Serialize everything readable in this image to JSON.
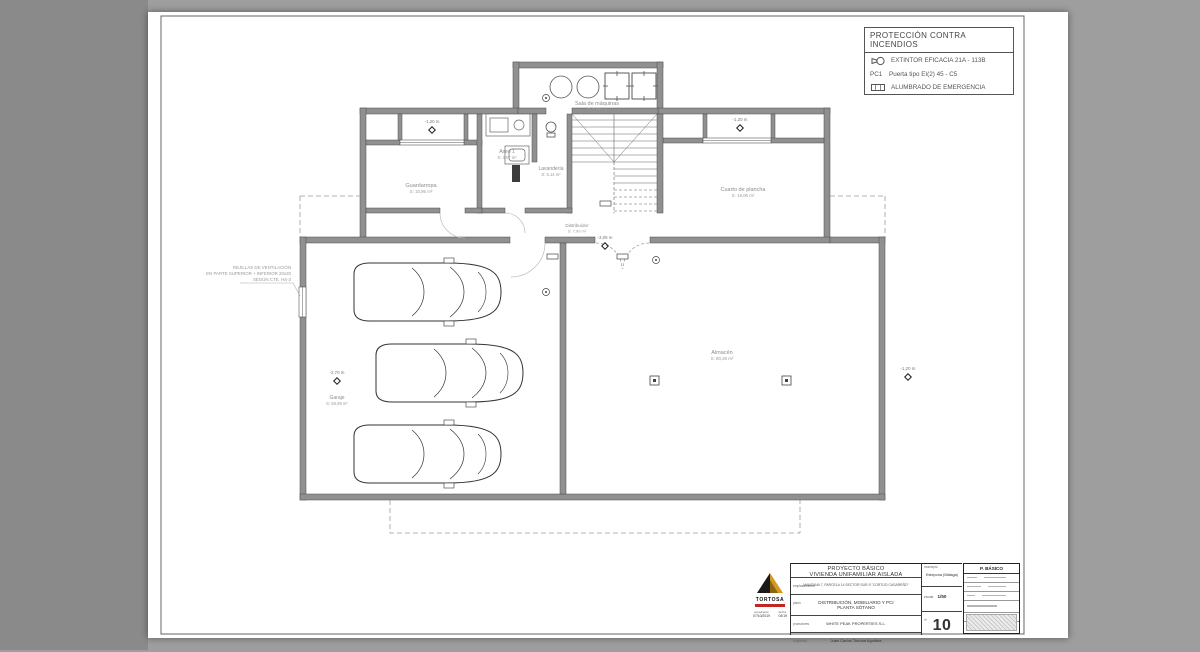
{
  "legend": {
    "title": "PROTECCIÓN CONTRA INCENDIOS",
    "row1_label": "EXTINTOR EFICACIA 21A - 113B",
    "row2_prefix": "PC1",
    "row2_label": "Puerta tipo EI(2) 45 - C5",
    "row3_label": "ALUMBRADO DE EMERGENCIA"
  },
  "plan": {
    "rooms": [
      {
        "name": "Sala de máquinas",
        "area": "S: 7,06 m²"
      },
      {
        "name": "Aseo 1",
        "area": "S: 4,07 m²"
      },
      {
        "name": "Lavandería",
        "area": "S: 5,14 m²"
      },
      {
        "name": "Guardarropa",
        "area": "S: 10,95 m²"
      },
      {
        "name": "Cuarto de plancha",
        "area": "S: 19,06 m²"
      },
      {
        "name": "Distribuidor",
        "area": "S: 7,90 m²"
      },
      {
        "name": "Garaje",
        "area": "S: 66,99 m²"
      },
      {
        "name": "Almacén",
        "area": "S: 80,28 m²"
      }
    ],
    "levels": [
      "-1,20 m",
      "-1,20 m",
      "-3,05 m",
      "-2,70 m",
      "-1,20 m"
    ],
    "note_line1": "REJILLAS DE VENTILACIÓN",
    "note_line2": "EN PARTE SUPERIOR + INFERIOR 20x20",
    "note_line3": "SEGÚN CTE. HS-3"
  },
  "titleblock": {
    "project_line1": "PROYECTO BÁSICO",
    "project_line2": "VIVIENDA UNIFAMILIAR AISLADA",
    "emplazamiento_label": "emplazamiento",
    "emplazamiento": "MANZANA 7, PARCELA 14 SECTOR SUR-9 \"CORTIJO CASAREÑO\"",
    "plano_label": "plano",
    "plano_line1": "DISTRIBUCIÓN, MOBILIARIO Y PCI",
    "plano_line2": "PLANTA SÓTANO",
    "promotores_label": "promotores",
    "promotores": "WHITE PEAK PROPERTIES S.L.",
    "arquitecto_label": "arquitecto",
    "arquitecto": "Juan Carlos Tortosa Aguilera",
    "expediente_label": "expediente",
    "expediente": "07/10/2019",
    "fecha_label": "fecha",
    "fecha": "04/19",
    "municipio_label": "municipio",
    "municipio": "Estepona (Málaga)",
    "escala_label": "escala",
    "escala": "1/50",
    "numero_label": "nº",
    "numero": "10",
    "logo_text": "TORTOSA"
  },
  "stamp": {
    "title": "P. BÁSICO"
  }
}
